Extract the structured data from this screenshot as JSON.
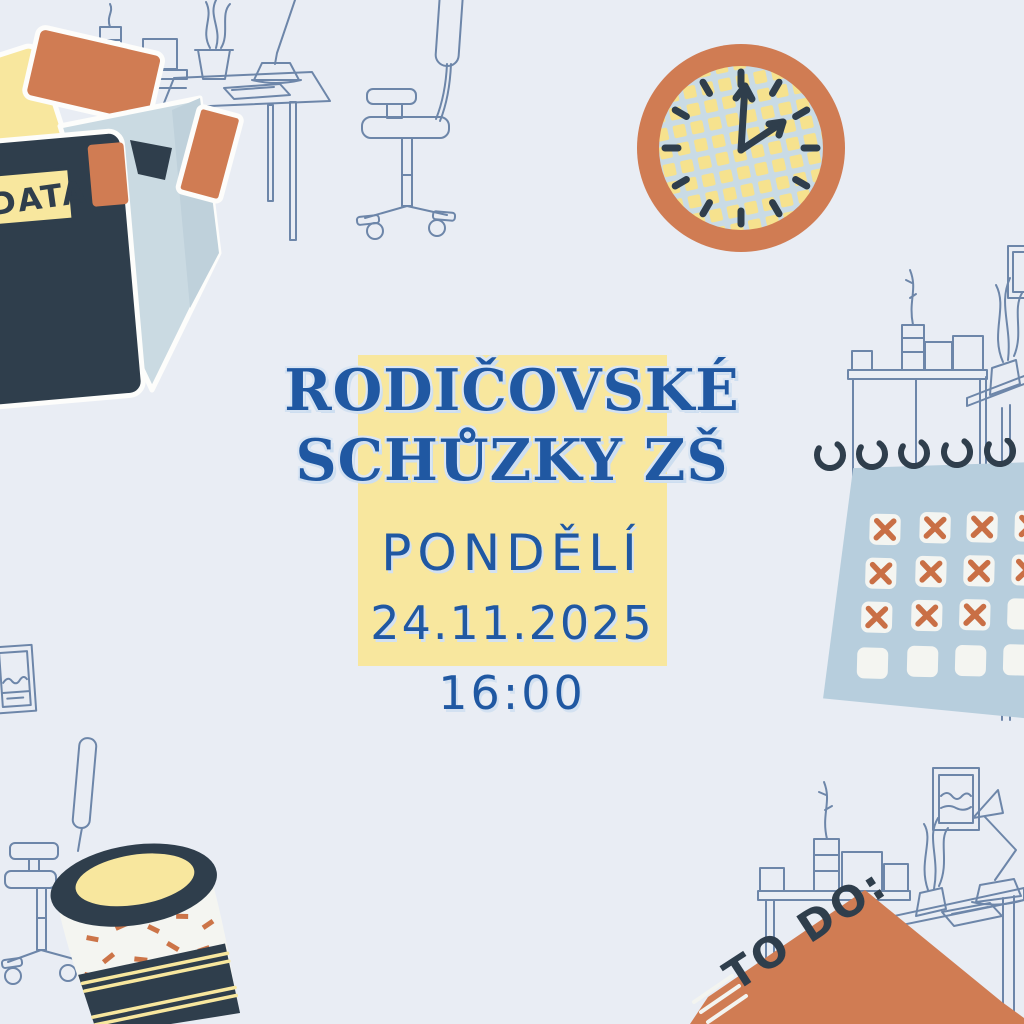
{
  "palette": {
    "background": "#e9edf4",
    "yellow": "#f8e79e",
    "navy": "#2f3e4c",
    "blue": "#2058a2",
    "terracotta": "#d07c53",
    "paper_blue": "#cadae2",
    "calendar_blue": "#b7cedd",
    "line_blue": "#6d86a9",
    "white": "#f4f5f1",
    "x_orange": "#c96f45"
  },
  "event": {
    "title_line1": "RODIČOVSKÉ",
    "title_line2": "SCHŮZKY ZŠ",
    "day": "PONDĚLÍ",
    "date": "24.11.2025",
    "time": "16:00"
  },
  "decor": {
    "folder_label": "DATA",
    "notebook_label": "TO DO:"
  }
}
